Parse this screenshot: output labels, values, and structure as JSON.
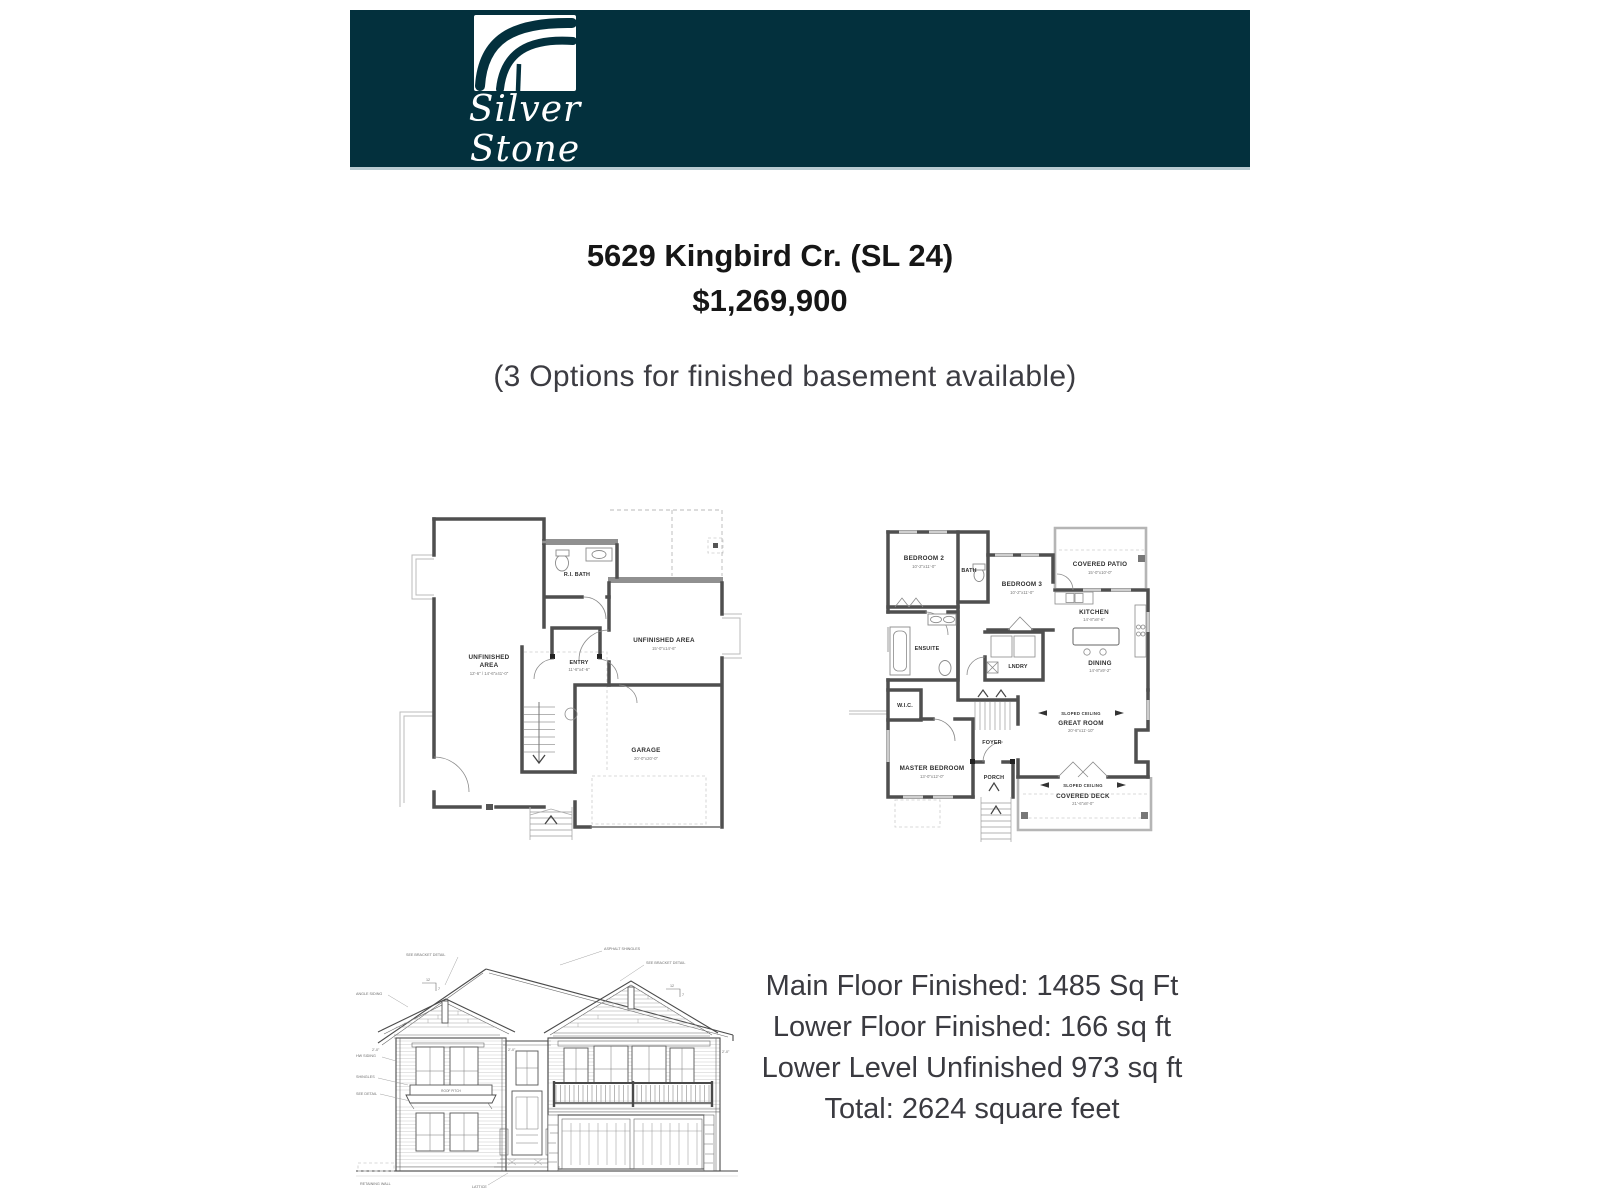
{
  "brand": {
    "script_name": "Silver Stone",
    "sub_name": "HEIGHTS",
    "header_bg": "#03303d"
  },
  "listing": {
    "address": "5629 Kingbird Cr. (SL 24)",
    "price": "$1,269,900",
    "availability_note": "(3 Options for finished basement available)"
  },
  "lower_plan": {
    "labels": {
      "ri_bath": "R.I. BATH",
      "unfinished1": "UNFINISHED",
      "unfinished2": "AREA",
      "unfinished_dim": "12'-6\" / 14'-6\"x41'-0\"",
      "entry": "ENTRY",
      "entry_dim": "11'-6\"x4'-6\"",
      "unfinished_right": "UNFINISHED AREA",
      "unfinished_right_dim": "15'-0\"x14'-6\"",
      "garage": "GARAGE",
      "garage_dim": "20'-0\"x20'-0\""
    }
  },
  "main_plan": {
    "labels": {
      "bedroom2": "BEDROOM 2",
      "bedroom2_dim": "10'-2\"x11'-0\"",
      "bath": "BATH",
      "bedroom3": "BEDROOM 3",
      "bedroom3_dim": "10'-2\"x11'-0\"",
      "covered_patio": "COVERED PATIO",
      "covered_patio_dim": "15'-0\"x10'-0\"",
      "kitchen": "KITCHEN",
      "kitchen_dim": "14'-8\"x8'-6\"",
      "ensuite": "ENSUITE",
      "lndry": "LNDRY",
      "dining": "DINING",
      "dining_dim": "14'-8\"x9'-2\"",
      "wic": "W.I.C.",
      "sloped_ceiling": "SLOPED CEILING",
      "great_room": "GREAT ROOM",
      "great_room_dim": "20'-6\"x11'-10\"",
      "foyer": "FOYER",
      "master": "MASTER BEDROOM",
      "master_dim": "13'-0\"x12'-0\"",
      "porch": "PORCH",
      "covered_deck": "COVERED DECK",
      "covered_deck_dim": "21'-6\"x8'-0\""
    }
  },
  "elevation": {
    "annotations": {
      "see_bracket": "SEE BRACKET DETAIL",
      "asphalt_shingles": "ASPHALT SHINGLES",
      "angle_siding": "ANGLE SIDING",
      "hw_siding": "HW SIDING",
      "shingles": "SHINGLES",
      "see_detail": "SEE DETAIL",
      "lattice": "LATTICE",
      "retaining_wall": "RETAINING WALL",
      "roof_pitch": "ROOF PITCH",
      "pitch_run": "12",
      "pitch_rise": "7",
      "overhang": "2'-0\""
    }
  },
  "summary": {
    "line1": "Main Floor Finished: 1485 Sq Ft",
    "line2": "Lower Floor Finished: 166 sq ft",
    "line3": "Lower Level Unfinished 973 sq ft",
    "line4": "Total:  2624 square feet"
  }
}
